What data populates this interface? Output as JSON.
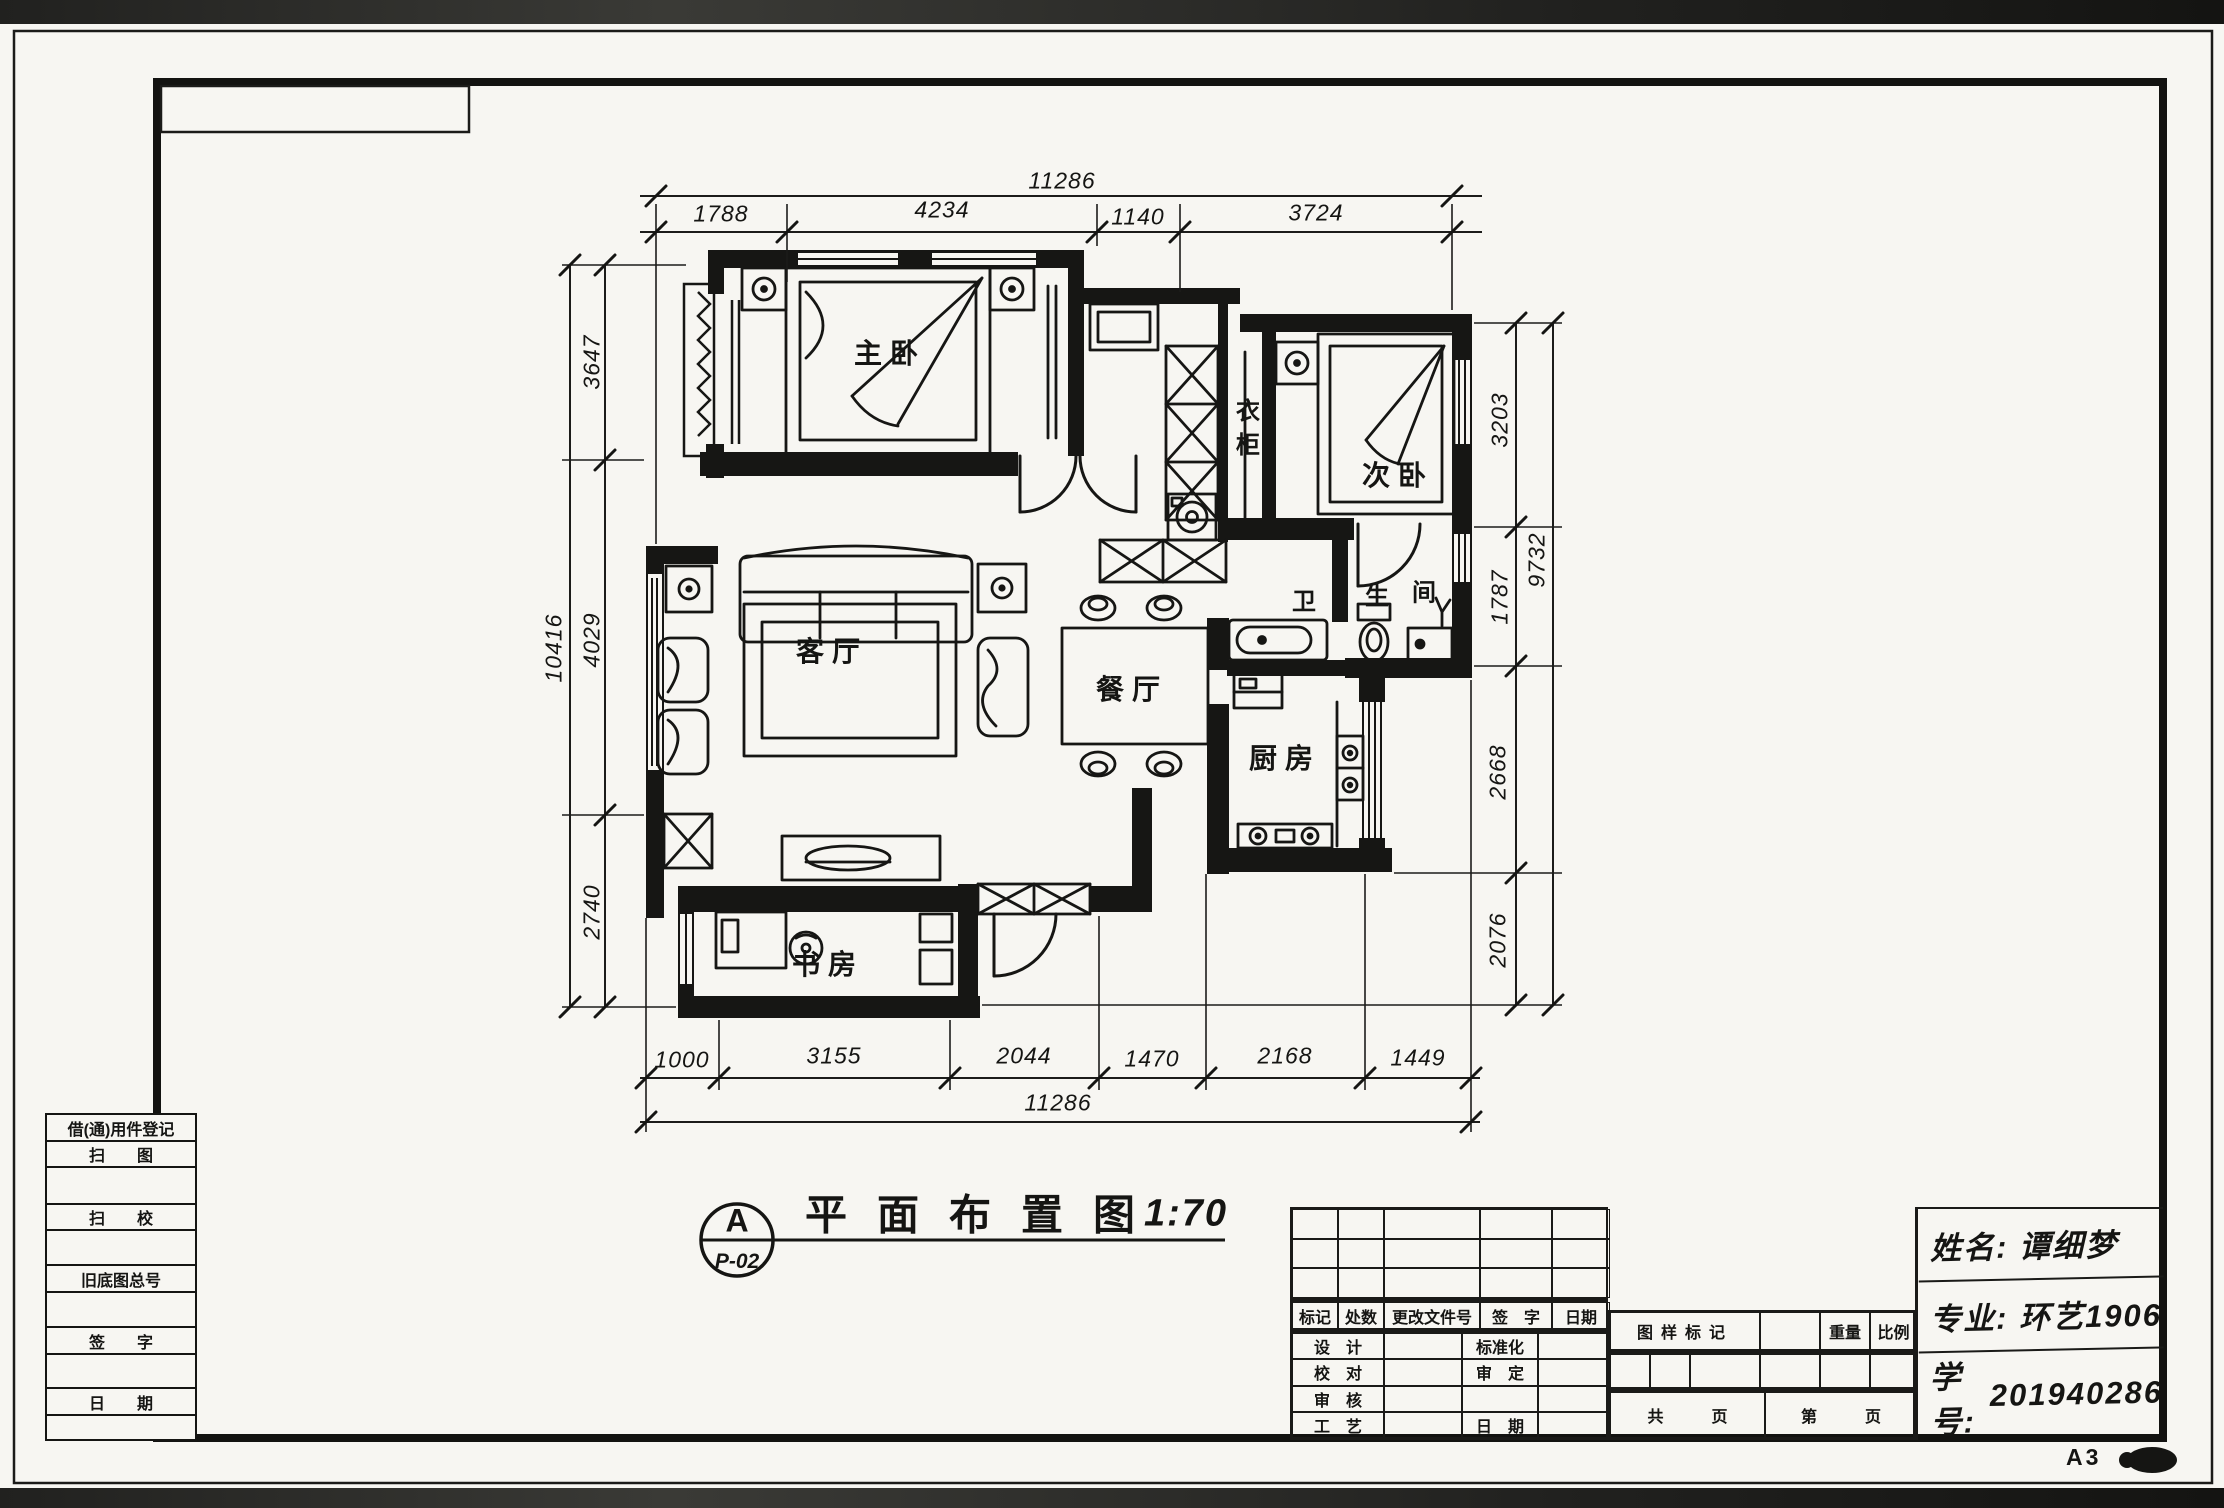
{
  "sheet": {
    "size_label": "A3"
  },
  "plan_title": {
    "callout_letter": "A",
    "callout_ref": "P-02",
    "text": "平面布置图",
    "scale": "1:70"
  },
  "rooms": {
    "master": "主卧",
    "second": "次卧",
    "wardrobe": "衣柜",
    "living": "客厅",
    "dining": "餐厅",
    "kitchen": "厨房",
    "study": "书房",
    "bath_1": "卫",
    "bath_2": "生",
    "bath_3": "间"
  },
  "dims": {
    "top_total": "11286",
    "top": [
      "1788",
      "4234",
      "1140",
      "3724"
    ],
    "bottom": [
      "1000",
      "3155",
      "2044",
      "1470",
      "2168",
      "1449"
    ],
    "bottom_total": "11286",
    "left": [
      "3647",
      "4029",
      "2740"
    ],
    "left_total": "10416",
    "right": [
      "3203",
      "1787",
      "2668",
      "2076"
    ],
    "right_total": "9732"
  },
  "left_block": {
    "rows": [
      "借(通)用件登记",
      "扫　　图",
      "扫　　校",
      "旧底图总号",
      "签　　字",
      "日　　期"
    ]
  },
  "title_block": {
    "revision_header": [
      "标记",
      "处数",
      "更改文件号",
      "签　字",
      "日期"
    ],
    "rows": {
      "r1l": "设　计",
      "r1m": "标准化",
      "r2l": "校　对",
      "r2m": "审　定",
      "r3l": "审　核",
      "r3m": "",
      "r4l": "工　艺",
      "r4m": "日　期"
    },
    "stamp": {
      "mark": "图样标记",
      "weight": "重量",
      "ratio": "比例",
      "total_pages": "共　　　页",
      "page_no": "第　　　页"
    },
    "info": {
      "name_label": "姓名:",
      "name_value": "谭细梦",
      "major_label": "专业:",
      "major_value": "环艺1906",
      "id_label": "学号:",
      "id_value": "201940286"
    }
  }
}
